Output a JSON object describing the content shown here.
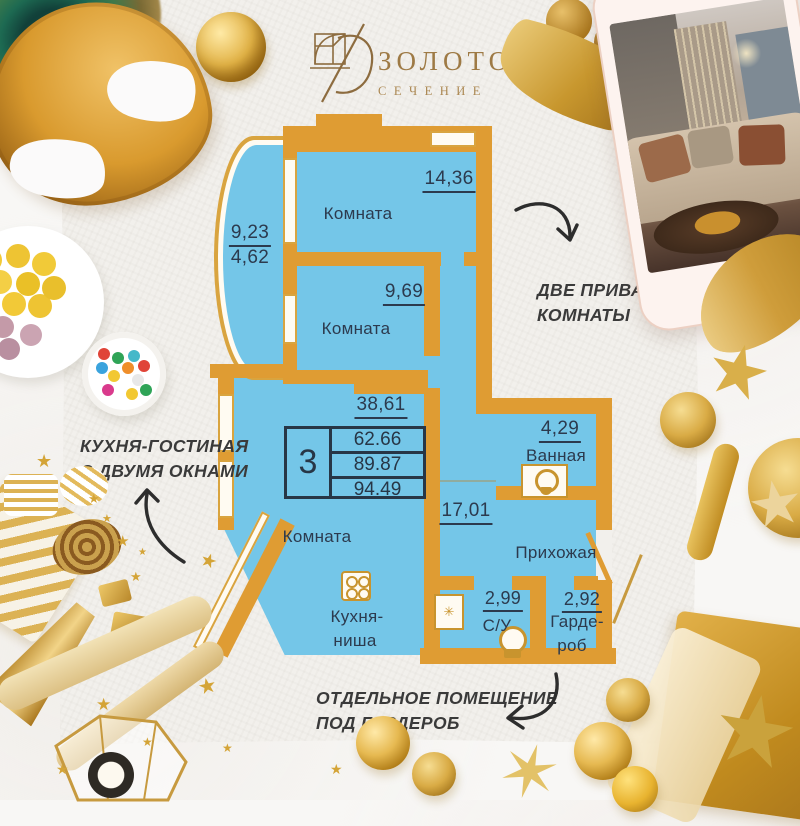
{
  "logo": {
    "title": "ЗОЛОТОЕ",
    "subtitle": "СЕЧЕНИЕ"
  },
  "summary": {
    "room_count": "3",
    "areas": [
      "62.66",
      "89.87",
      "94.49"
    ]
  },
  "rooms": {
    "room1": {
      "label": "Комната",
      "area": "14,36"
    },
    "room2": {
      "label": "Комната",
      "area": "9,69"
    },
    "living": {
      "label": "Комната",
      "area": "38,61"
    },
    "kitchen": {
      "line1": "Кухня-",
      "line2": "ниша"
    },
    "balcony": {
      "area_full": "9,23",
      "area_half": "4,62"
    },
    "bathroom": {
      "label": "Ванная",
      "area": "4,29"
    },
    "hallway": {
      "label": "Прихожая",
      "area": "17,01"
    },
    "wc": {
      "label": "С/У",
      "area": "2,99"
    },
    "wardrobe": {
      "line1": "Гарде-",
      "line2": "роб",
      "area": "2,92"
    }
  },
  "annotations": {
    "private_rooms": {
      "line1": "ДВЕ ПРИВАТНЫЕ",
      "line2": "КОМНАТЫ"
    },
    "kitchen_living": {
      "line1": "КУХНЯ-ГОСТИНАЯ",
      "line2": "С ДВУМЯ ОКНАМИ"
    },
    "wardrobe_room": {
      "line1": "ОТДЕЛЬНОЕ ПОМЕЩЕНИЕ",
      "line2": "ПОД ГАРДЕРОБ"
    }
  },
  "colors": {
    "wall": "#DF9C33",
    "room_fill": "#74C6E8",
    "plan_text": "#2C3A4E",
    "fixture_gold": "#C8942E",
    "logo_gold": "#9E7A45",
    "annotation_ink": "#3A3A3A"
  }
}
